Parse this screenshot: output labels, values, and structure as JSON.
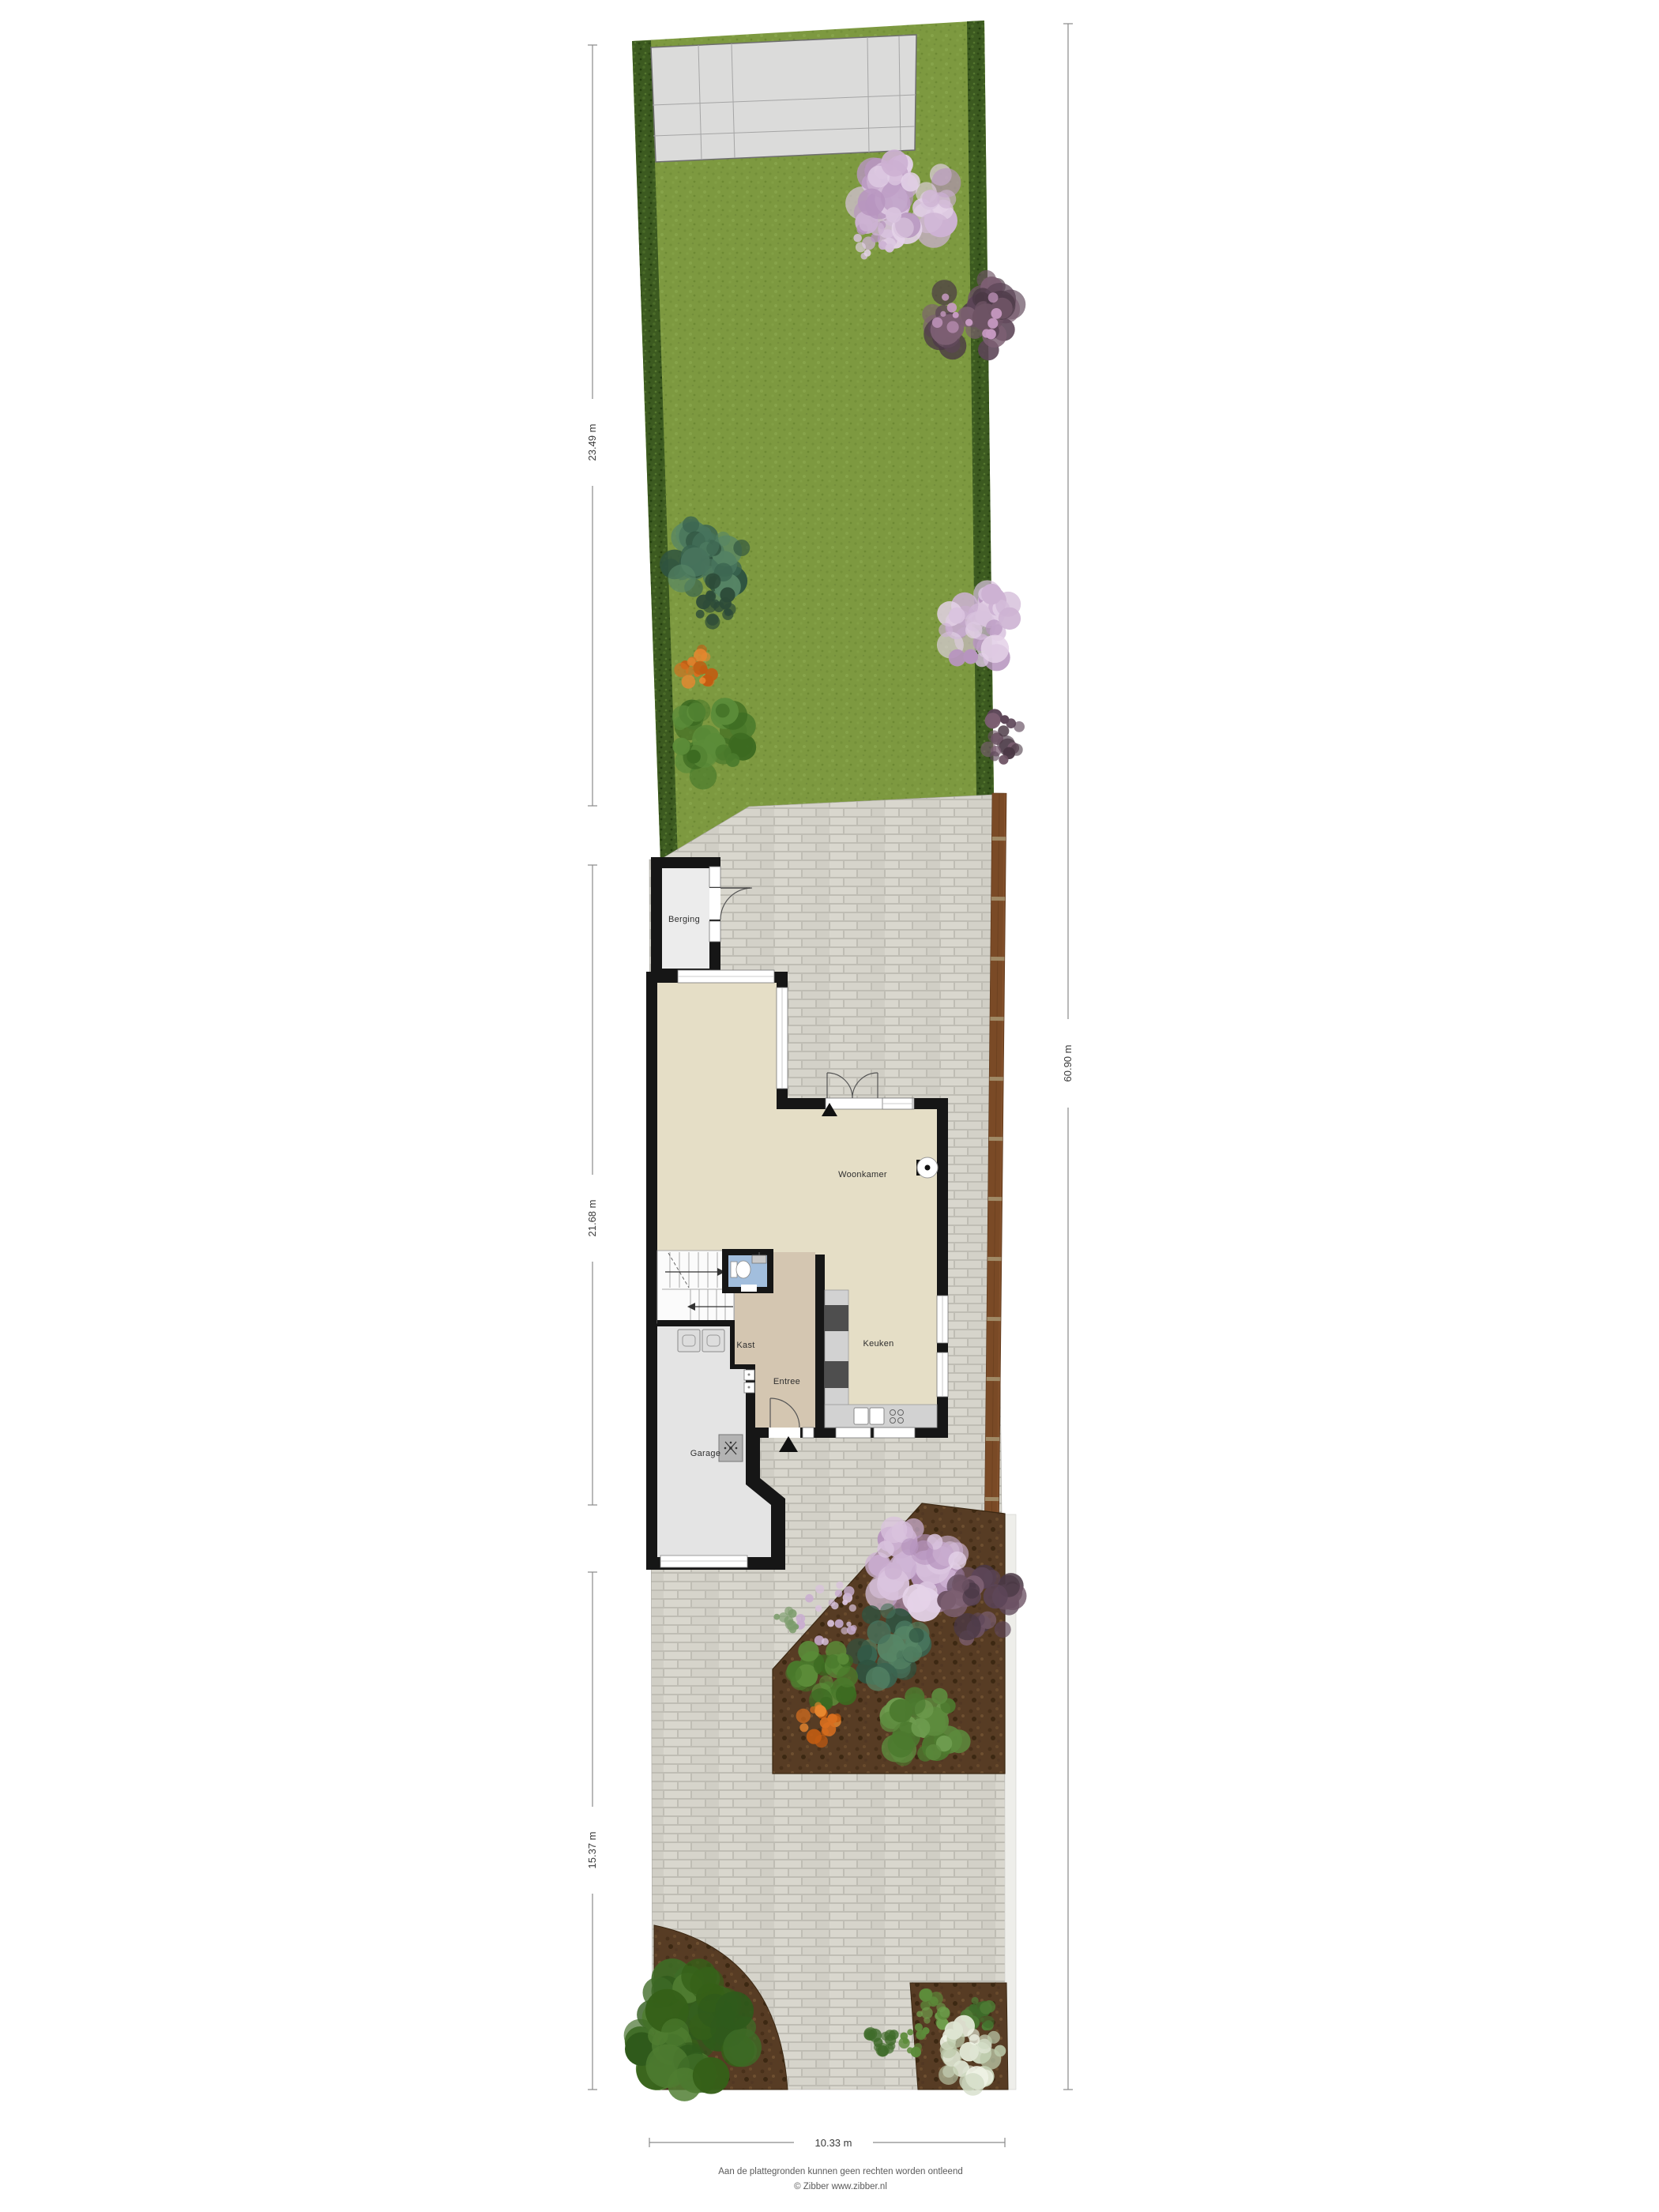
{
  "plan": {
    "rooms": {
      "berging": "Berging",
      "woonkamer": "Woonkamer",
      "keuken": "Keuken",
      "entree": "Entree",
      "kast": "Kast",
      "garage": "Garage"
    },
    "dimensions": {
      "garden_depth": "23.49 m",
      "house_depth": "21.68 m",
      "driveway_depth": "15.37 m",
      "total_depth": "60.90 m",
      "plot_width": "10.33 m"
    },
    "footer": {
      "disclaimer": "Aan de plattegronden kunnen geen rechten worden ontleend",
      "credit": "© Zibber www.zibber.nl"
    },
    "colors": {
      "grass": "#7d9940",
      "hedge": "#3c5a20",
      "paving": "#d5d3ca",
      "floor": "#e5dec6",
      "entree_floor": "#d4c6b1",
      "bathroom_floor": "#a2bedd",
      "wall": "#161616",
      "soil": "#573c24",
      "fence": "#7a4a26"
    }
  }
}
